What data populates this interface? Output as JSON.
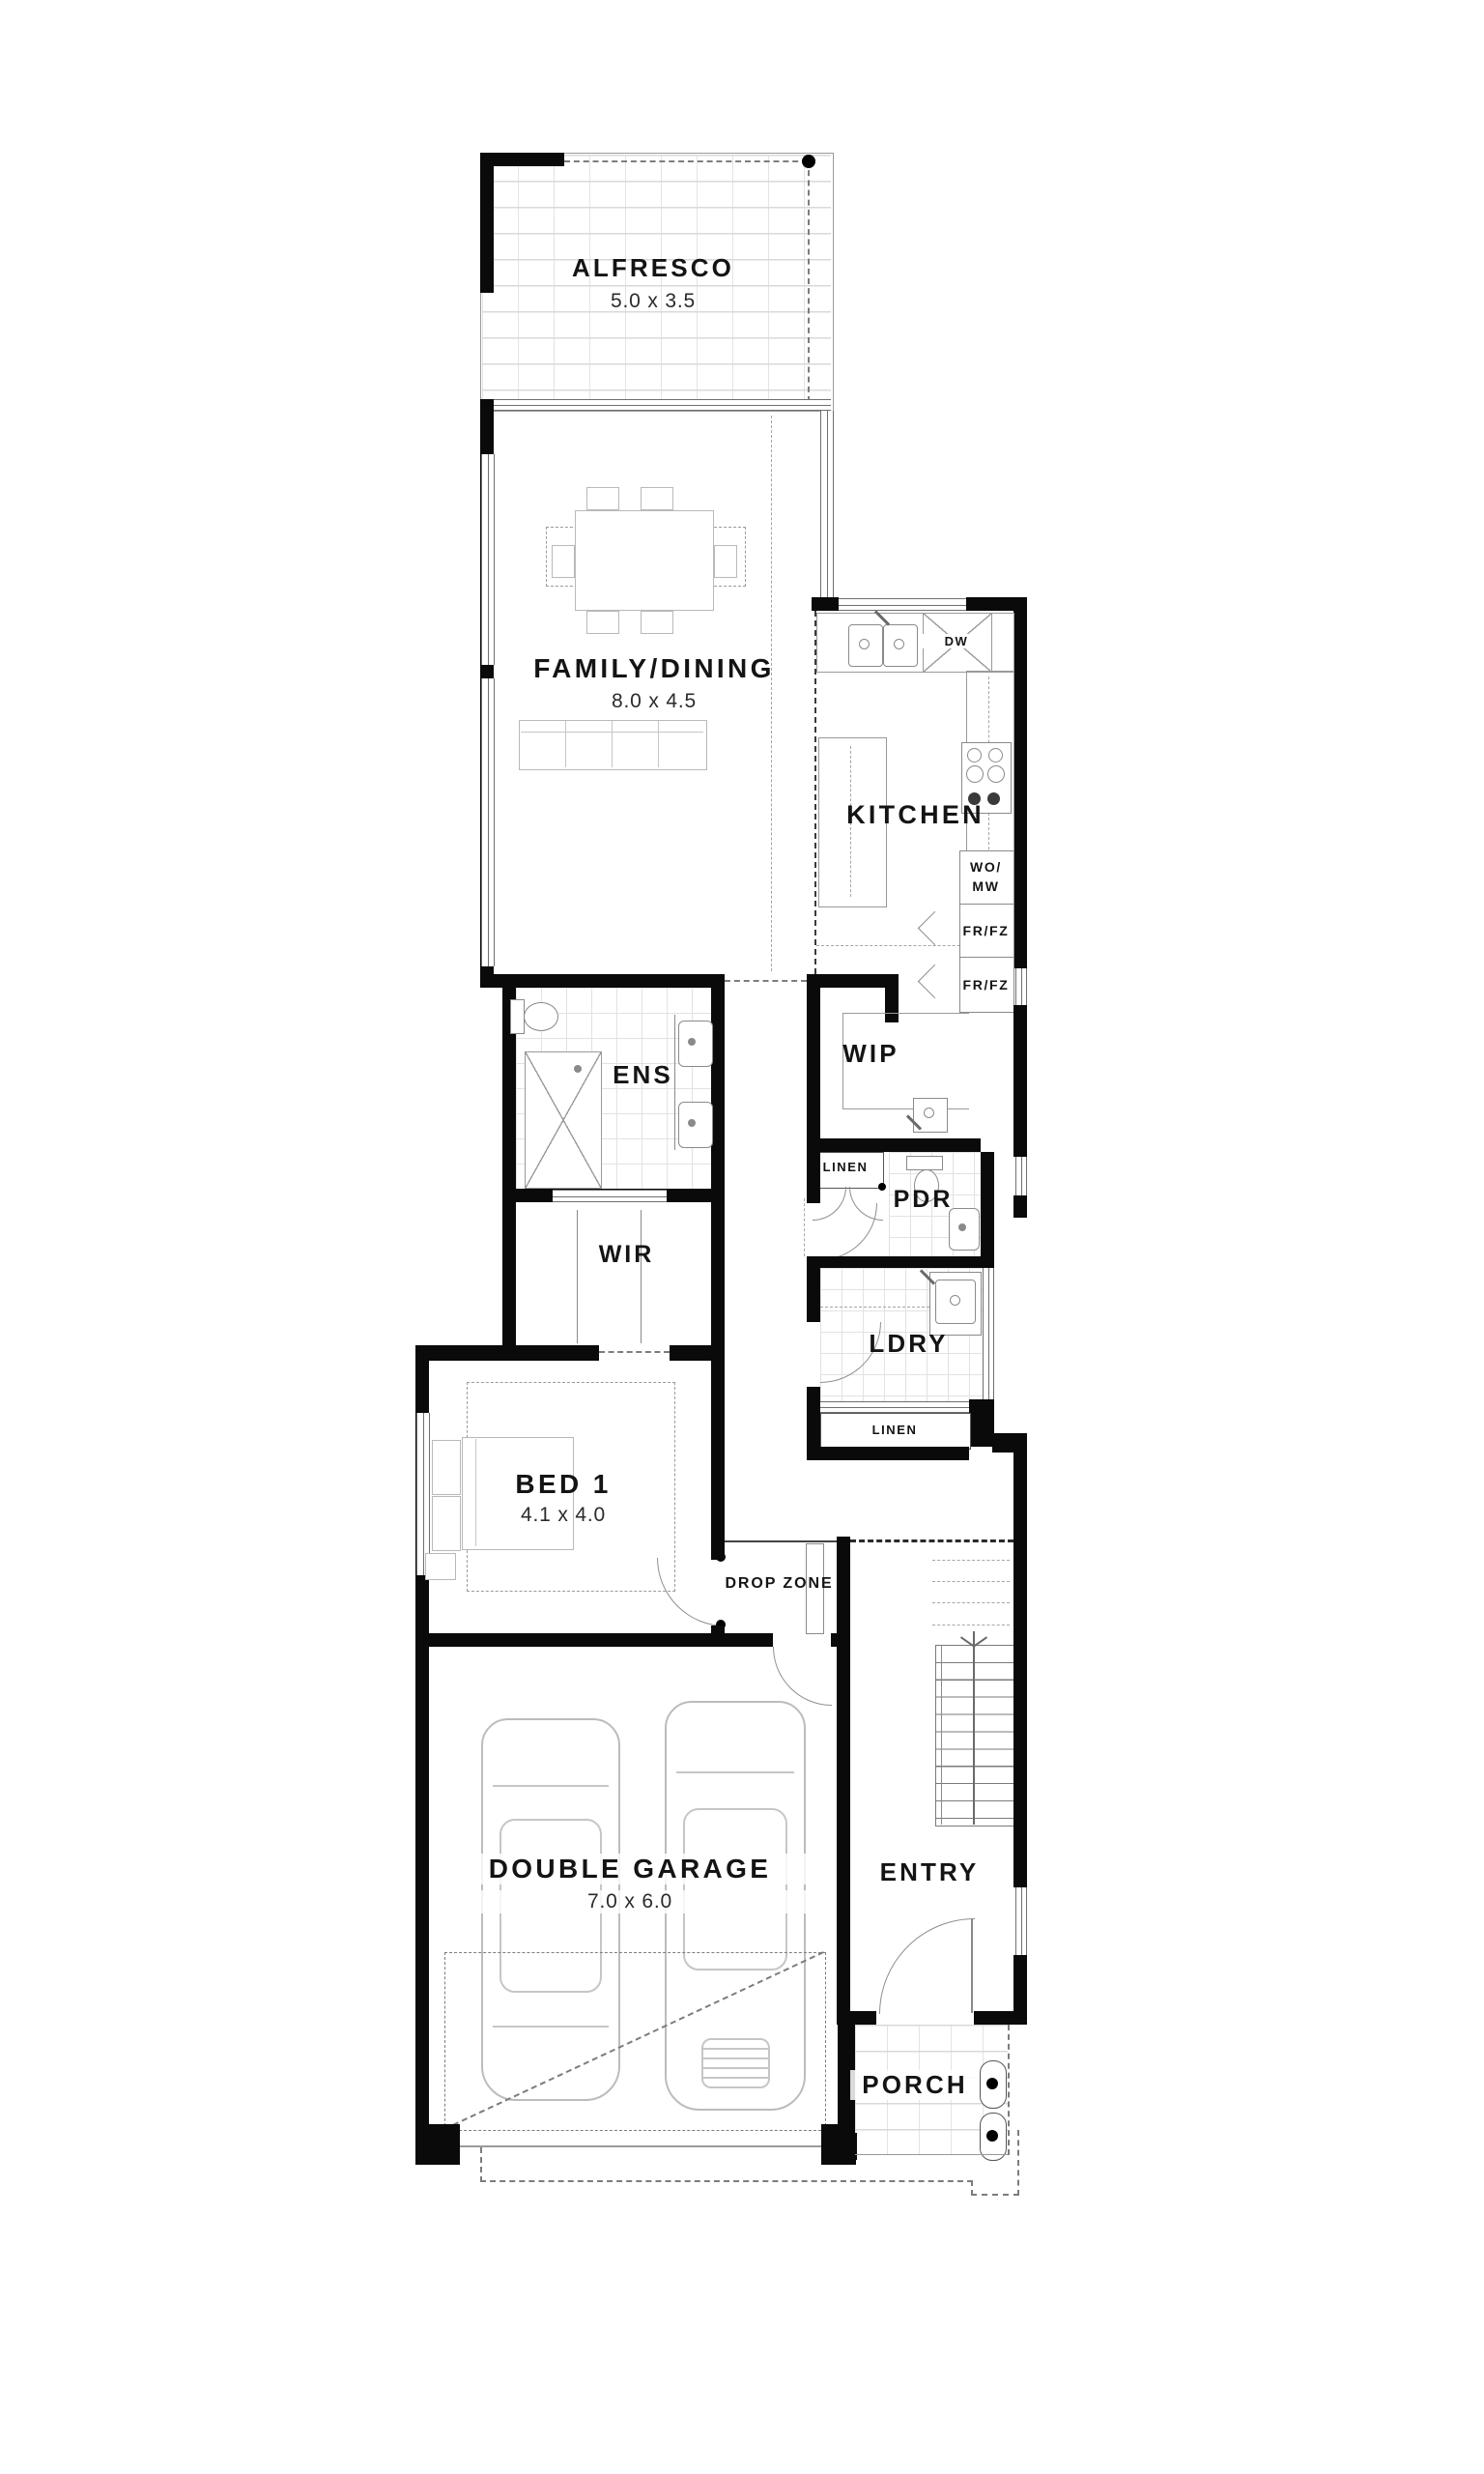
{
  "plan": {
    "alfresco": {
      "name": "ALFRESCO",
      "dims": "5.0 x 3.5"
    },
    "family_dining": {
      "name": "FAMILY/DINING",
      "dims": "8.0 x 4.5"
    },
    "kitchen": {
      "name": "KITCHEN"
    },
    "wip": {
      "name": "WIP"
    },
    "ens": {
      "name": "ENS"
    },
    "wir": {
      "name": "WIR"
    },
    "pdr": {
      "name": "PDR"
    },
    "ldry": {
      "name": "LDRY"
    },
    "bed1": {
      "name": "BED 1",
      "dims": "4.1 x 4.0"
    },
    "drop_zone": {
      "name": "DROP ZONE"
    },
    "garage": {
      "name": "DOUBLE GARAGE",
      "dims": "7.0 x 6.0"
    },
    "entry": {
      "name": "ENTRY"
    },
    "porch": {
      "name": "PORCH"
    },
    "linen_upper": "LINEN",
    "linen_lower": "LINEN",
    "dw": "DW",
    "wo_mw": "WO/\nMW",
    "fr_fz_1": "FR/FZ",
    "fr_fz_2": "FR/FZ"
  },
  "colors": {
    "wall": "#0a0a0a",
    "line": "#8a8a8a",
    "tile": "#e2e2e2",
    "text": "#141414"
  }
}
